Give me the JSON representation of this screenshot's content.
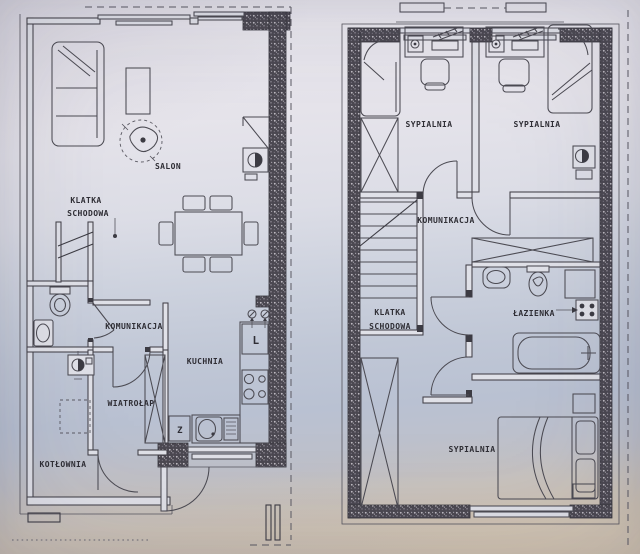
{
  "ground_floor": {
    "rooms": {
      "salon": "SALON",
      "klatka_line1": "KLATKA",
      "klatka_line2": "SCHODOWA",
      "komunikacja": "KOMUNIKACJA",
      "kuchnia": "KUCHNIA",
      "wiatrolap": "WIATROŁAP",
      "kotlownia": "KOTŁOWNIA"
    },
    "symbols": {
      "fridge": "L",
      "dishwasher": "Z"
    }
  },
  "upper_floor": {
    "rooms": {
      "sypialnia_left": "SYPIALNIA",
      "sypialnia_right": "SYPIALNIA",
      "komunikacja": "KOMUNIKACJA",
      "klatka_line1": "KLATKA",
      "klatka_line2": "SCHODOWA",
      "lazienka": "ŁAZIENKA",
      "sypialnia_master": "SYPIALNIA"
    }
  },
  "colors": {
    "ink": "#3c3b43",
    "wall_hatch_dark": "#4a4750",
    "paper_top": "#ebe9f0",
    "paper_mid": "#c0c7d6",
    "paper_bottom": "#d3c7b6"
  }
}
